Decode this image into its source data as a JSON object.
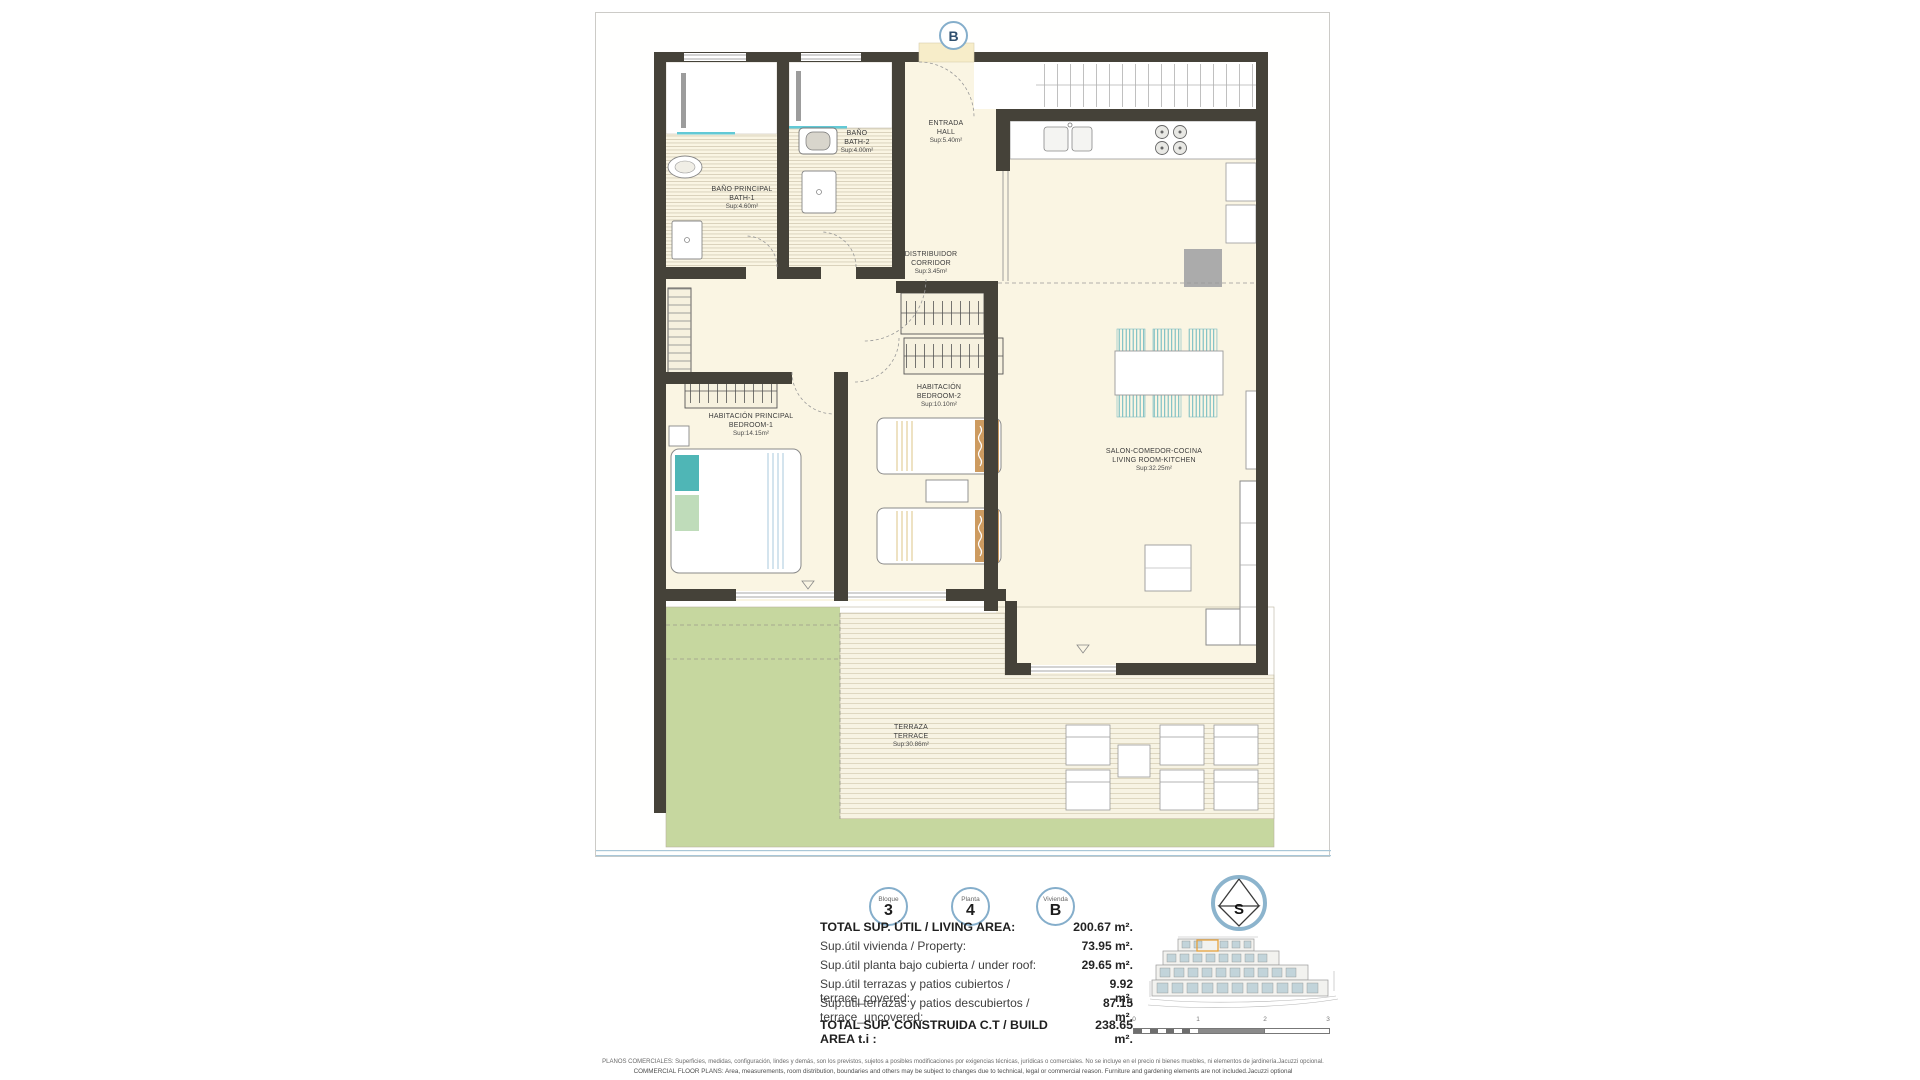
{
  "sheet": {
    "unit_marker": "B"
  },
  "rooms": [
    {
      "es": "BAÑO PRINCIPAL",
      "en": "BATH-1",
      "area": "Sup:4.60m²"
    },
    {
      "es": "BAÑO",
      "en": "BATH-2",
      "area": "Sup:4.00m²"
    },
    {
      "es": "ENTRADA",
      "en": "HALL",
      "area": "Sup:5.40m²"
    },
    {
      "es": "DISTRIBUIDOR",
      "en": "CORRIDOR",
      "area": "Sup:3.45m²"
    },
    {
      "es": "HABITACIÓN PRINCIPAL",
      "en": "BEDROOM-1",
      "area": "Sup:14.15m²"
    },
    {
      "es": "HABITACIÓN",
      "en": "BEDROOM-2",
      "area": "Sup:10.10m²"
    },
    {
      "es": "SALON-COMEDOR-COCINA",
      "en": "LIVING ROOM-KITCHEN",
      "area": "Sup:32.25m²"
    },
    {
      "es": "TERRAZA",
      "en": "TERRACE",
      "area": "Sup:30.86m²"
    }
  ],
  "legend": {
    "badges": [
      {
        "label": "Bloque",
        "value": "3"
      },
      {
        "label": "Planta",
        "value": "4"
      },
      {
        "label": "Vivienda",
        "value": "B"
      }
    ],
    "compass_letter": "S"
  },
  "areas_table": {
    "rows": [
      {
        "label": "TOTAL SUP. ÚTIL / LIVING AREA:",
        "value": "200.67 m²."
      },
      {
        "label": "Sup.útil vivienda / Property:",
        "value": "73.95 m²."
      },
      {
        "label": "Sup.útil planta bajo cubierta / under roof:",
        "value": "29.65 m²."
      },
      {
        "label": "Sup.útil terrazas y patios cubiertos / terrace_covered:",
        "value": "9.92 m²."
      },
      {
        "label": "Sup.útil terrazas y patios descubiertos / terrace_uncovered:",
        "value": "87.15 m²."
      },
      {
        "label": "TOTAL SUP. CONSTRUIDA C.T / BUILD AREA t.i :",
        "value": "238.65 m²."
      }
    ]
  },
  "scalebar": {
    "ticks": [
      "0",
      "1",
      "2",
      "3"
    ]
  },
  "disclaimer": {
    "es": "PLANOS COMERCIALES: Superficies, medidas, configuración, lindes y demás, son los previstos, sujetos a posibles modificaciones por exigencias técnicas, jurídicas o comerciales. No se incluye en el precio ni bienes muebles, ni elementos de jardinería.Jacuzzi opcional.",
    "en": "COMMERCIAL FLOOR PLANS: Area, measurements, room distribution, boundaries and others may be subject to changes due to technical, legal or commercial reason. Furniture and gardening elements are not included.Jacuzzi optional"
  },
  "colors": {
    "wall": "#454239",
    "floor_cream": "#faf5e3",
    "garden_green": "#c6d79f",
    "accent_blue_ring": "#85aecb",
    "glass_cyan": "#62c9d6",
    "bed_teal": "#4fb6b6",
    "bed_tan": "#cd9b60",
    "highlight_orange": "#e6a23c"
  }
}
